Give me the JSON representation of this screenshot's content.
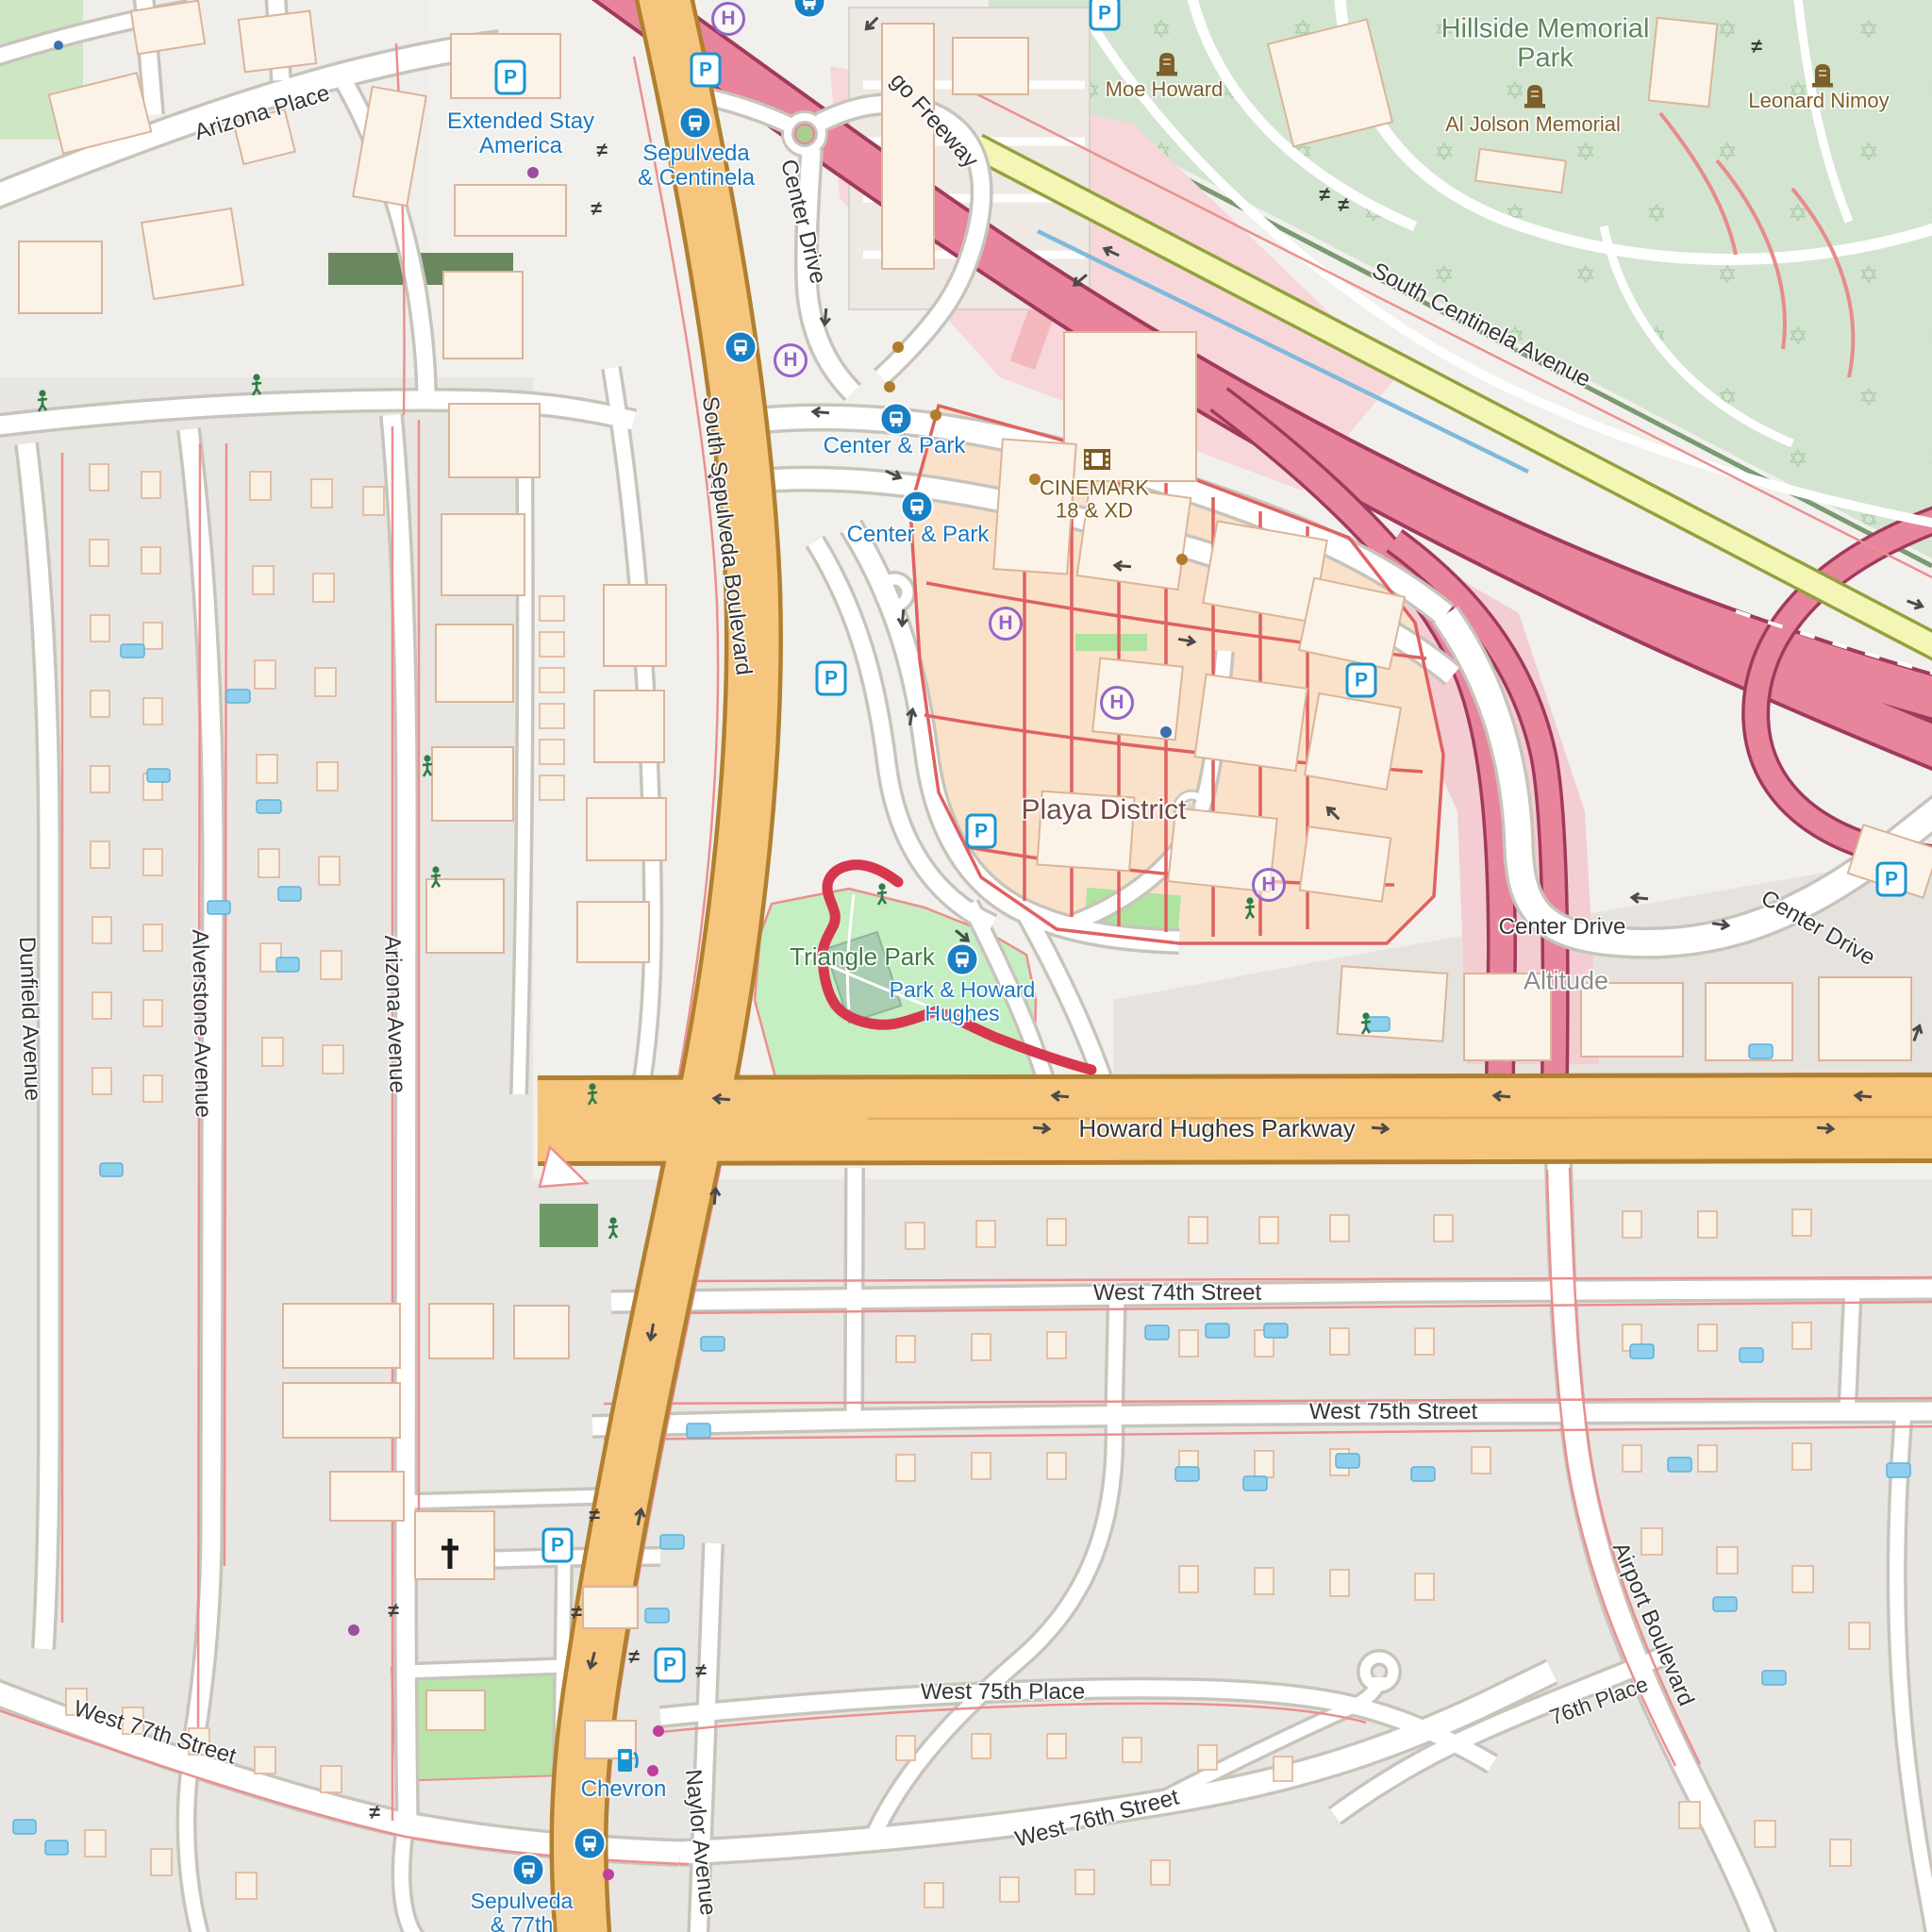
{
  "labels": {
    "streets": {
      "arizona_place": "Arizona Place",
      "center_drive_north": "Center Drive",
      "freeway": "go Freeway",
      "south_centinela_avenue": "South Centinela Avenue",
      "south_sepulveda_boulevard": "South Sepulveda Boulevard",
      "center_drive_east_1": "Center Drive",
      "center_drive_east_2": "Center Drive",
      "howard_hughes_parkway": "Howard Hughes Parkway",
      "dunfield_avenue": "Dunfield Avenue",
      "alverstone_avenue": "Alverstone Avenue",
      "arizona_avenue": "Arizona Avenue",
      "west_74th_street": "West 74th Street",
      "west_75th_street": "West 75th Street",
      "west_75th_place": "West 75th Place",
      "west_76th_street": "West 76th Street",
      "west_77th_street": "West 77th Street",
      "naylor_avenue": "Naylor Avenue",
      "airport_boulevard": "Airport Boulevard",
      "place_76th": "76th Place"
    },
    "places": {
      "hillside_line1": "Hillside Memorial",
      "hillside_line2": "Park",
      "moe_howard": "Moe Howard",
      "al_jolson_memorial": "Al Jolson Memorial",
      "leonard_nimoy": "Leonard Nimoy",
      "playa_district": "Playa District",
      "triangle_park": "Triangle Park",
      "altitude": "Altitude",
      "cinemark_line1": "CINEMARK",
      "cinemark_line2": "18 & XD",
      "extended_stay_line1": "Extended Stay",
      "extended_stay_line2": "America",
      "chevron": "Chevron"
    },
    "transit": {
      "sepulveda_centinela_line1": "Sepulveda",
      "sepulveda_centinela_line2": "& Centinela",
      "center_and_park_a": "Center & Park",
      "center_and_park_b": "Center & Park",
      "park_and_howard_line1": "Park & Howard",
      "park_and_howard_line2": "Hughes",
      "sepulveda_77th_line1": "Sepulveda",
      "sepulveda_77th_line2": "& 77th"
    }
  },
  "icons": {
    "parking_glyph": "P",
    "helipad_glyph": "H",
    "barrier_glyph": "≠"
  },
  "colors": {
    "motorway_fill": "#e8849b",
    "motorway_casing": "#a03a5d",
    "trunk_fill": "#f6c57e",
    "trunk_casing": "#b08030",
    "secondary_fill": "#f4f6b5",
    "secondary_casing": "#93a13d",
    "park_green": "#c5eec2",
    "cemetery_green": "#d3e5d0",
    "retail_peach": "#f9e2c9",
    "route_red": "#d6374e",
    "water_blue": "#8fd0ee",
    "transit_blue": "#1a80c4",
    "helipad_purple": "#9565c8",
    "grave_brown": "#7d5f2b"
  }
}
